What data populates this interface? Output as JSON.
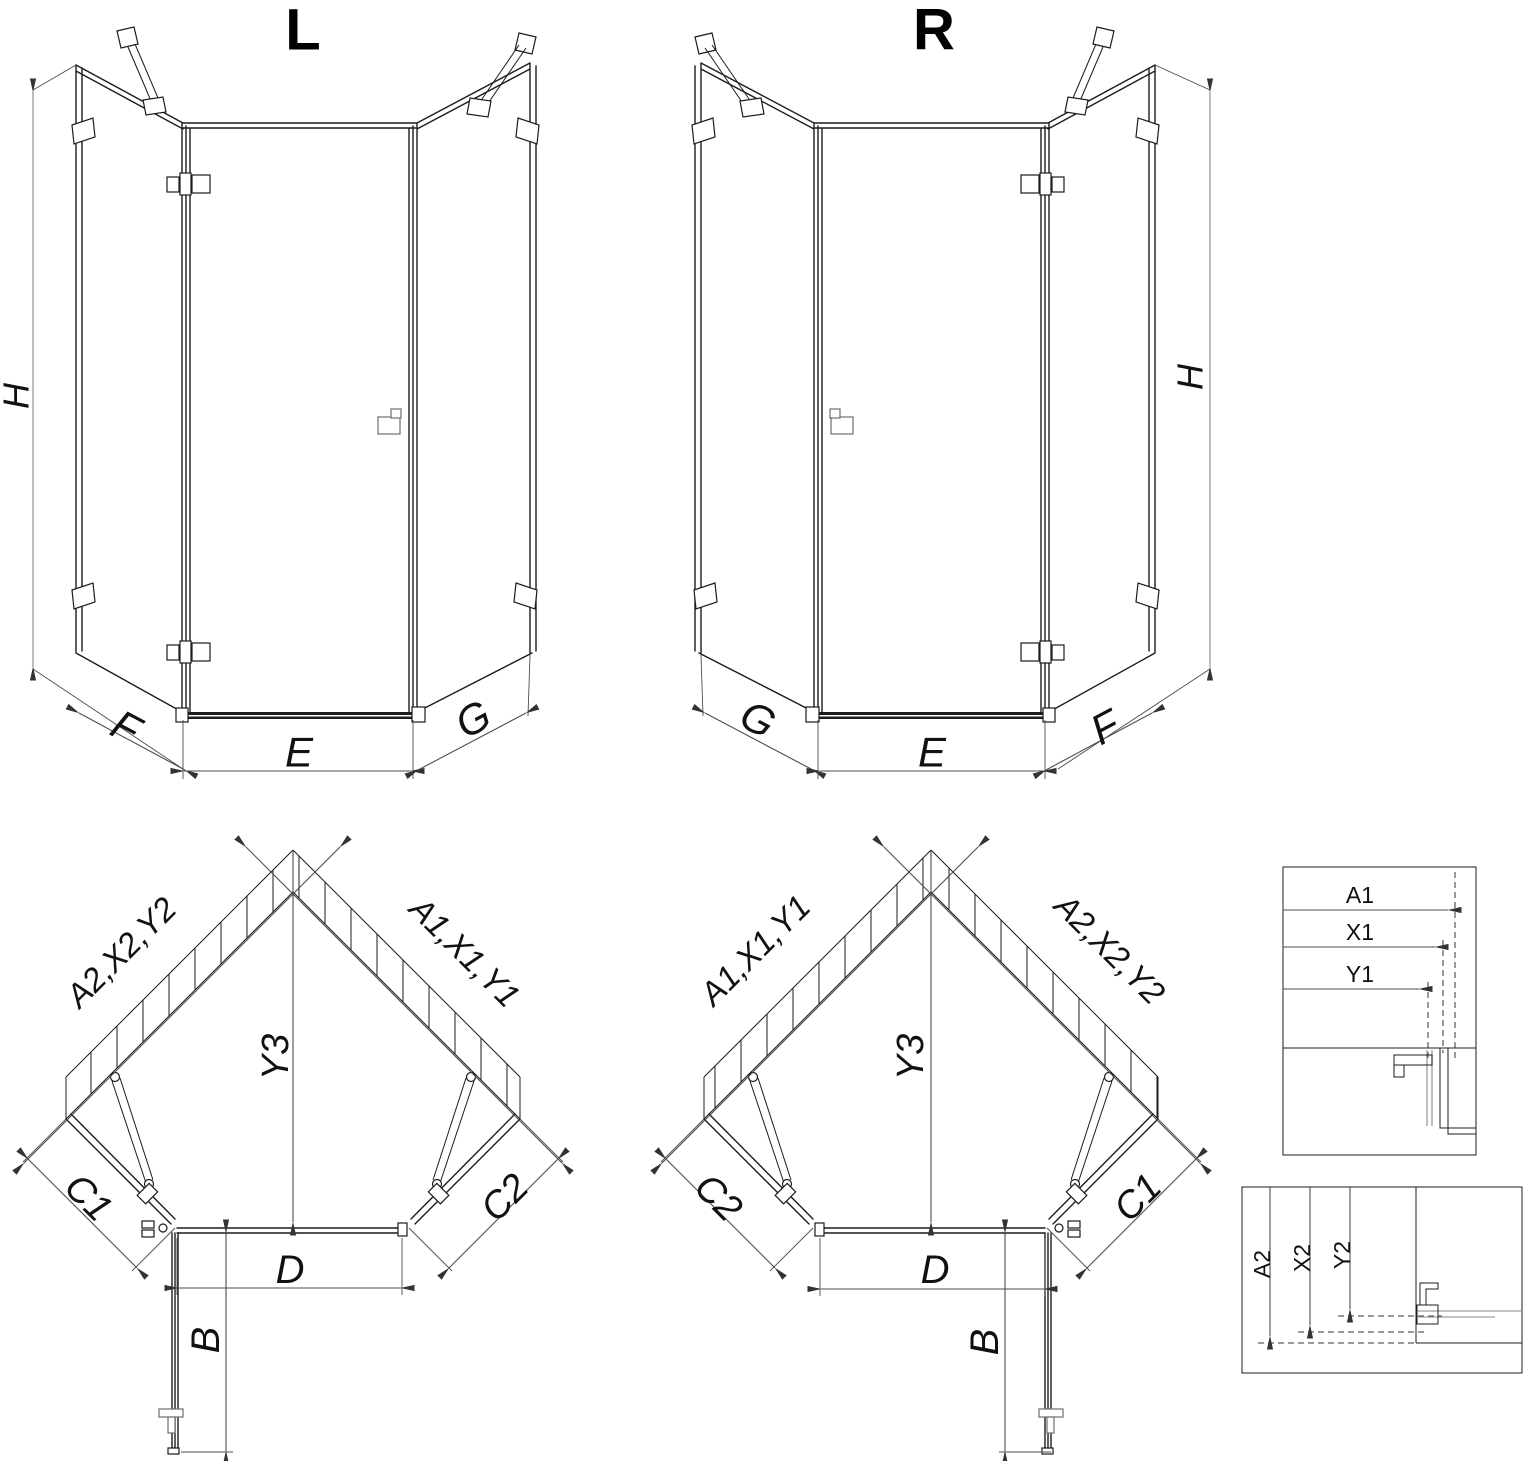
{
  "colors": {
    "stroke": "#1c1c1c",
    "dim": "#4d4d4d",
    "gray": "#9c9c9c",
    "background": "#ffffff"
  },
  "view_3d_left": {
    "title": "L",
    "height_label": "H",
    "left_label": "F",
    "front_label": "E",
    "right_label": "G"
  },
  "view_3d_right": {
    "title": "R",
    "height_label": "H",
    "left_label": "G",
    "front_label": "E",
    "right_label": "F"
  },
  "plan_left": {
    "wall_left_label": "A2,X2,Y2",
    "wall_right_label": "A1,X1,Y1",
    "depth_label": "Y3",
    "panel_left_label": "C1",
    "panel_right_label": "C2",
    "door_label": "D",
    "open_door_label": "B"
  },
  "plan_right": {
    "wall_left_label": "A1,X1,Y1",
    "wall_right_label": "A2,X2,Y2",
    "depth_label": "Y3",
    "panel_left_label": "C2",
    "panel_right_label": "C1",
    "door_label": "D",
    "open_door_label": "B"
  },
  "detail_wall_offsets": {
    "a_label": "A1",
    "x_label": "X1",
    "y_label": "Y1"
  },
  "detail_floor_offsets": {
    "a_label": "A2",
    "x_label": "X2",
    "y_label": "Y2"
  }
}
